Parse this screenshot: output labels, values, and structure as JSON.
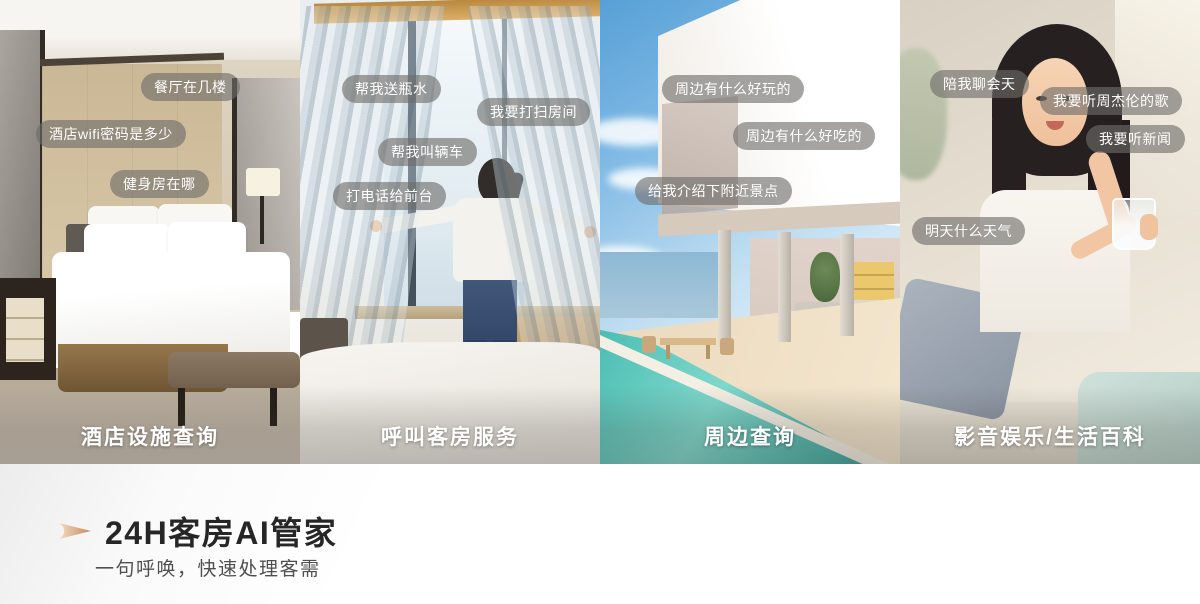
{
  "panels": [
    {
      "name": "hotel-facilities",
      "caption": "酒店设施查询",
      "tags": [
        "餐厅在几楼",
        "酒店wifi密码是多少",
        "健身房在哪"
      ]
    },
    {
      "name": "room-service",
      "caption": "呼叫客房服务",
      "tags": [
        "帮我送瓶水",
        "我要打扫房间",
        "帮我叫辆车",
        "打电话给前台"
      ]
    },
    {
      "name": "nearby-query",
      "caption": "周边查询",
      "tags": [
        "周边有什么好玩的",
        "周边有什么好吃的",
        "给我介绍下附近景点"
      ]
    },
    {
      "name": "entertainment-encyclopedia",
      "caption": "影音娱乐/生活百科",
      "tags": [
        "陪我聊会天",
        "我要听周杰伦的歌",
        "我要听新闻",
        "明天什么天气"
      ]
    }
  ],
  "footer": {
    "title": "24H客房AI管家",
    "subtitle": "一句呼唤，快速处理客需"
  },
  "colors": {
    "tag_background": "rgba(110,108,105,0.62)",
    "tag_text": "#ffffff",
    "caption_text": "#ffffff",
    "title_text": "#262626",
    "subtitle_text": "#4f4f4f",
    "arrow_accent_light": "#f2dcc2",
    "arrow_accent_dark": "#c9875c"
  }
}
